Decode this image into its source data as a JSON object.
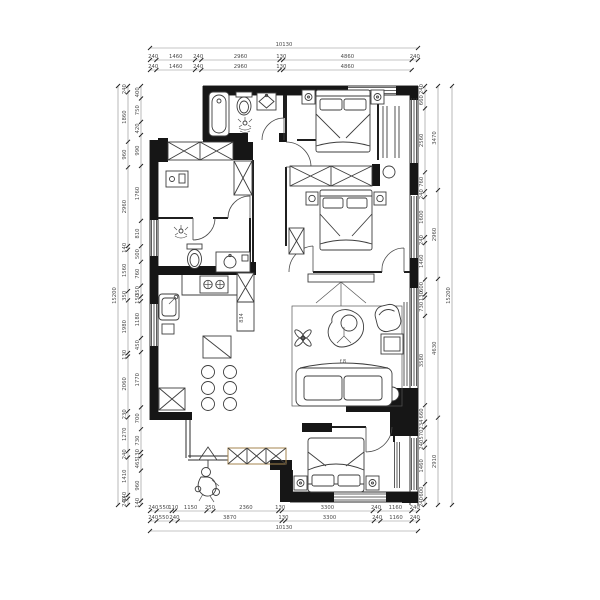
{
  "drawing": {
    "type": "apartment-floor-plan",
    "labels": {
      "cabinet_depth": "834",
      "coffee_table": "f.8"
    },
    "colors": {
      "wall": "#161616",
      "line": "#3d3d3d",
      "dim_text": "#4a4a4a"
    }
  },
  "dims": {
    "top": {
      "total": [
        "10130"
      ],
      "row1": [
        "240",
        "1460",
        "240",
        "2960",
        "130",
        "4860",
        "240"
      ],
      "row2": [
        "240",
        "1460",
        "240",
        "2960",
        "130",
        "4860"
      ]
    },
    "bottom": {
      "row1": [
        "240",
        "550",
        "110",
        "1150",
        "250",
        "2360",
        "130",
        "3300",
        "240",
        "1160",
        "240"
      ],
      "row2": [
        "240",
        "550",
        "240",
        "3870",
        "130",
        "3300",
        "240",
        "1160",
        "240"
      ],
      "total": [
        "10130"
      ]
    },
    "left": {
      "total": [
        "15200"
      ],
      "outer": [
        "240",
        "1860",
        "960",
        "2960",
        "140",
        "1560",
        "350",
        "1980",
        "130",
        "2060",
        "230",
        "1270",
        "240",
        "1410",
        "140",
        "240"
      ],
      "inner": [
        "400",
        "750",
        "420",
        "990",
        "1760",
        "810",
        "500",
        "760",
        "350",
        "150",
        "1180",
        "450",
        "1770",
        "700",
        "730",
        "130",
        "465",
        "960",
        "140"
      ]
    },
    "right": {
      "total": [
        "15200"
      ],
      "inner_segments": [
        "240",
        "660",
        "2560",
        "760",
        "240",
        "1600",
        "240",
        "1460",
        "600",
        "130",
        "730",
        "3580",
        "660",
        "234",
        "570",
        "240",
        "1460",
        "600",
        "240"
      ],
      "outer_spans": [
        "3470",
        "2960",
        "4630",
        "2910"
      ]
    }
  }
}
